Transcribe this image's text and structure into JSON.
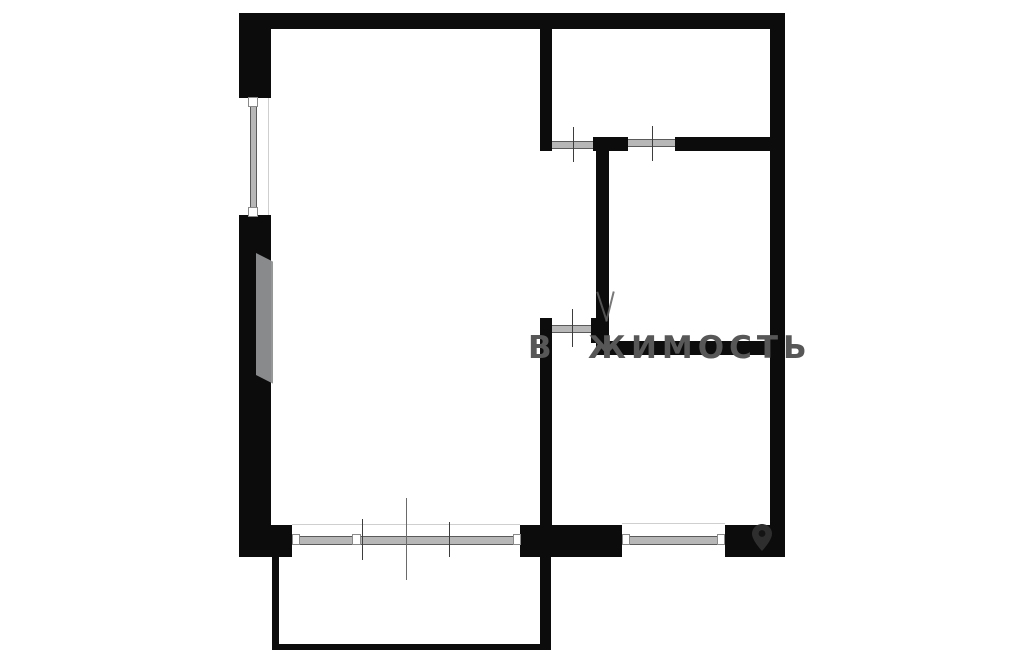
{
  "canvas": {
    "width": 1024,
    "height": 657,
    "background": "#ffffff"
  },
  "colors": {
    "wall": "#0c0c0c",
    "glazing_fill": "#b7b7b7",
    "glazing_edge": "#5a5a5a",
    "cap_fill": "#ffffff",
    "cap_edge": "#8a8a8a",
    "tick": "#3d3d3d",
    "faint_line": "#cfcfcf",
    "watermark_text": "#575757",
    "watermark_shape": "#8f9193",
    "pin": "#2e2e2e"
  },
  "watermark": {
    "fragment_left": "В",
    "fragment_right": "ЖИМОСТЬ",
    "pin_icon": "location-pin-icon"
  },
  "floorplan": {
    "elements": [
      {
        "name": "faint-line-left-window-jamb",
        "cls": "faint",
        "x": 268,
        "y": 98,
        "w": 1,
        "h": 117
      },
      {
        "name": "faint-line-main-window-face",
        "cls": "faint",
        "x": 292,
        "y": 524,
        "w": 228,
        "h": 1
      },
      {
        "name": "faint-line-kitchen-window-face",
        "cls": "faint",
        "x": 622,
        "y": 523,
        "w": 103,
        "h": 1
      },
      {
        "name": "top-exterior-wall",
        "cls": "wall",
        "x": 239,
        "y": 13,
        "w": 546,
        "h": 16
      },
      {
        "name": "left-exterior-wall-upper",
        "cls": "wall",
        "x": 239,
        "y": 13,
        "w": 32,
        "h": 85
      },
      {
        "name": "left-exterior-wall-lower",
        "cls": "wall",
        "x": 239,
        "y": 215,
        "w": 32,
        "h": 342
      },
      {
        "name": "right-exterior-wall",
        "cls": "wall",
        "x": 770,
        "y": 13,
        "w": 15,
        "h": 544
      },
      {
        "name": "bottom-wall-left-block",
        "cls": "wall",
        "x": 239,
        "y": 525,
        "w": 53,
        "h": 32
      },
      {
        "name": "bottom-wall-middle-block",
        "cls": "wall",
        "x": 520,
        "y": 525,
        "w": 102,
        "h": 32
      },
      {
        "name": "bottom-wall-right-block",
        "cls": "wall",
        "x": 725,
        "y": 525,
        "w": 60,
        "h": 32
      },
      {
        "name": "interior-wall-hall-left",
        "cls": "wall",
        "x": 540,
        "y": 27,
        "w": 12,
        "h": 124
      },
      {
        "name": "interior-wall-kitchen-left",
        "cls": "wall",
        "x": 540,
        "y": 318,
        "w": 12,
        "h": 239
      },
      {
        "name": "interior-wall-bath-left",
        "cls": "wall",
        "x": 596,
        "y": 151,
        "w": 13,
        "h": 190
      },
      {
        "name": "interior-wall-bath-corner",
        "cls": "wall",
        "x": 593,
        "y": 137,
        "w": 35,
        "h": 14
      },
      {
        "name": "interior-wall-hall-bottom",
        "cls": "wall",
        "x": 675,
        "y": 137,
        "w": 95,
        "h": 14
      },
      {
        "name": "interior-wall-kitchen-top",
        "cls": "wall",
        "x": 596,
        "y": 341,
        "w": 175,
        "h": 14
      },
      {
        "name": "interior-wall-kitchen-stub",
        "cls": "wall",
        "x": 591,
        "y": 318,
        "w": 17,
        "h": 25
      },
      {
        "name": "balcony-wall-left",
        "cls": "wall",
        "x": 272,
        "y": 552,
        "w": 7,
        "h": 98
      },
      {
        "name": "balcony-wall-bottom",
        "cls": "wall",
        "x": 272,
        "y": 644,
        "w": 279,
        "h": 6
      },
      {
        "name": "balcony-wall-right",
        "cls": "wall",
        "x": 540,
        "y": 557,
        "w": 11,
        "h": 93
      },
      {
        "name": "watermark-parallelogram",
        "cls": "wm-pgram",
        "x": 256,
        "y": 253,
        "w": 17,
        "h": 122
      },
      {
        "name": "watermark-fragment-left-stroke",
        "cls": "wm-frag-l",
        "x": 601,
        "y": 291,
        "w": 2,
        "h": 31
      },
      {
        "name": "watermark-fragment-right-stroke",
        "cls": "wm-frag-r",
        "x": 609,
        "y": 291,
        "w": 2,
        "h": 31
      },
      {
        "name": "left-window-glazing",
        "cls": "band band-v",
        "x": 250,
        "y": 107,
        "w": 7,
        "h": 101
      },
      {
        "name": "main-window-glazing",
        "cls": "band band-h",
        "x": 299,
        "y": 536,
        "w": 215,
        "h": 9
      },
      {
        "name": "kitchen-window-glazing",
        "cls": "band band-h",
        "x": 629,
        "y": 536,
        "w": 89,
        "h": 9
      },
      {
        "name": "door-opening-hall",
        "cls": "band band-h",
        "x": 552,
        "y": 141,
        "w": 41,
        "h": 8
      },
      {
        "name": "door-opening-bathroom",
        "cls": "band band-h",
        "x": 628,
        "y": 139,
        "w": 47,
        "h": 8
      },
      {
        "name": "door-opening-kitchen",
        "cls": "band band-h",
        "x": 552,
        "y": 325,
        "w": 39,
        "h": 8
      },
      {
        "name": "window-cap",
        "cls": "cap",
        "x": 248,
        "y": 97,
        "w": 10,
        "h": 10
      },
      {
        "name": "window-cap",
        "cls": "cap",
        "x": 248,
        "y": 207,
        "w": 10,
        "h": 10
      },
      {
        "name": "window-cap",
        "cls": "cap",
        "x": 292,
        "y": 534,
        "w": 8,
        "h": 11
      },
      {
        "name": "window-cap",
        "cls": "cap",
        "x": 352,
        "y": 534,
        "w": 9,
        "h": 11
      },
      {
        "name": "window-cap",
        "cls": "cap",
        "x": 513,
        "y": 534,
        "w": 8,
        "h": 11
      },
      {
        "name": "window-cap",
        "cls": "cap",
        "x": 622,
        "y": 534,
        "w": 8,
        "h": 11
      },
      {
        "name": "window-cap",
        "cls": "cap",
        "x": 717,
        "y": 534,
        "w": 8,
        "h": 11
      },
      {
        "name": "door-tick",
        "cls": "tick",
        "x": 573,
        "y": 127,
        "w": 1,
        "h": 35
      },
      {
        "name": "door-tick",
        "cls": "tick",
        "x": 652,
        "y": 126,
        "w": 1,
        "h": 35
      },
      {
        "name": "door-tick",
        "cls": "tick",
        "x": 572,
        "y": 309,
        "w": 1,
        "h": 38
      },
      {
        "name": "window-tick",
        "cls": "tick",
        "x": 362,
        "y": 519,
        "w": 1,
        "h": 41
      },
      {
        "name": "window-tick",
        "cls": "tick",
        "x": 449,
        "y": 522,
        "w": 1,
        "h": 35
      },
      {
        "name": "window-measure-line",
        "cls": "measure",
        "x": 406,
        "y": 498,
        "w": 1,
        "h": 82
      }
    ]
  }
}
